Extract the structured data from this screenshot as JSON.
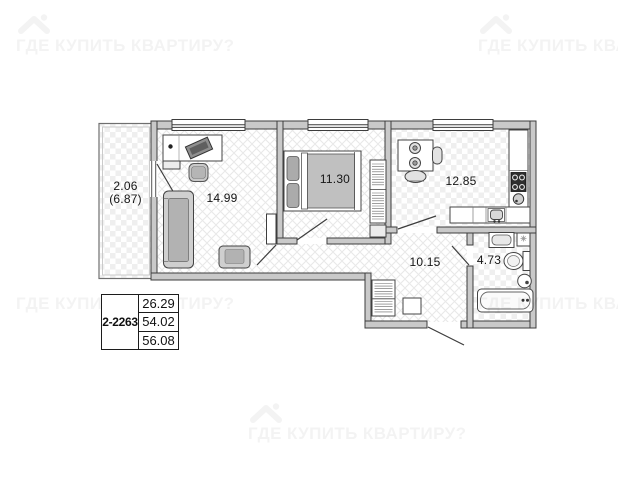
{
  "watermark": {
    "text": "ГДЕ КУПИТЬ КВАРТИРУ?"
  },
  "plan": {
    "rooms": {
      "balcony": {
        "area": "2.06",
        "area_alt": "(6.87)"
      },
      "living_room": {
        "area": "14.99"
      },
      "bedroom": {
        "area": "11.30"
      },
      "kitchen": {
        "area": "12.85"
      },
      "hallway": {
        "area": "10.15"
      },
      "bathroom": {
        "area": "4.73"
      }
    }
  },
  "info_table": {
    "unit_id": "2-2263",
    "rows": [
      "26.29",
      "54.02",
      "56.08"
    ]
  },
  "colors": {
    "wall_fill": "#c9c9c9",
    "wall_stroke": "#3d3d3d",
    "watermark": "rgba(10,10,10,0.05)"
  }
}
